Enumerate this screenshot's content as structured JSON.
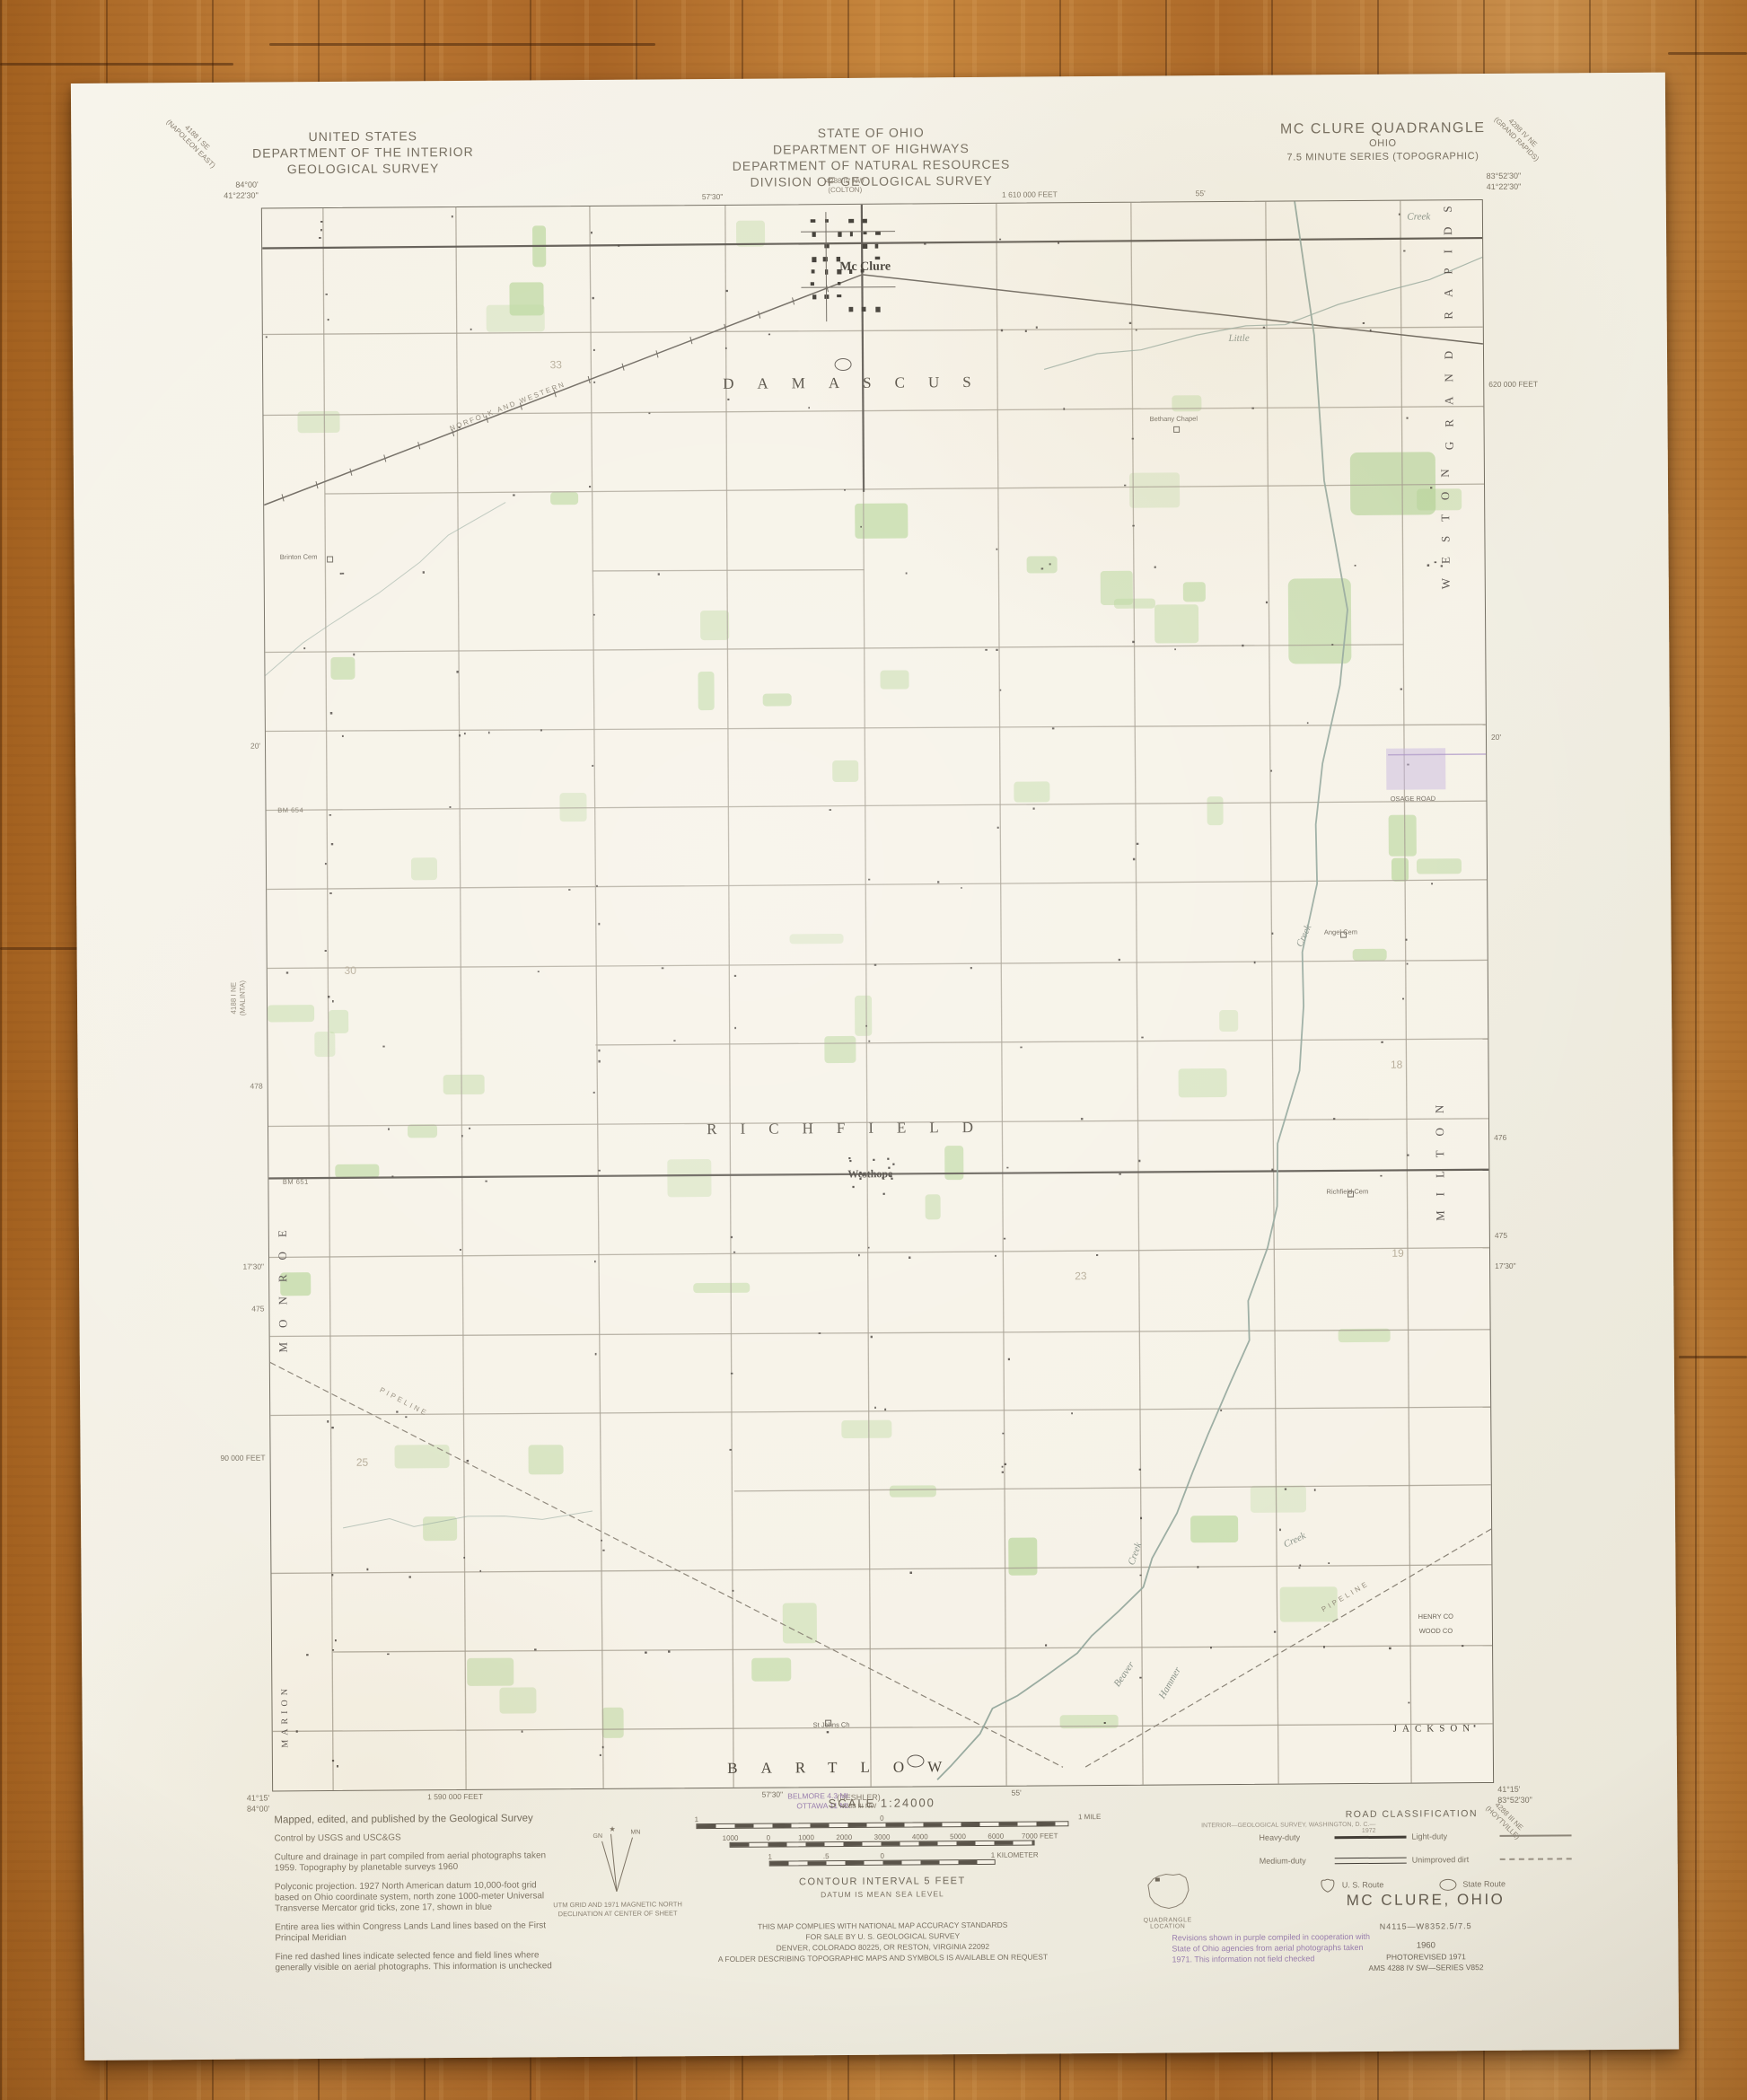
{
  "colors": {
    "paper": "#f6f2e7",
    "wood": "#b5722e",
    "ink": "#6a6257",
    "purple": "#9a7fae",
    "green": "#cfe3b3",
    "township_ink": "#4e483d"
  },
  "header": {
    "usgs": [
      "UNITED STATES",
      "DEPARTMENT OF THE INTERIOR",
      "GEOLOGICAL SURVEY"
    ],
    "ohio": [
      "STATE OF OHIO",
      "DEPARTMENT OF HIGHWAYS",
      "DEPARTMENT OF NATURAL RESOURCES",
      "DIVISION OF GEOLOGICAL SURVEY"
    ],
    "quad": [
      "MC CLURE QUADRANGLE",
      "OHIO",
      "7.5 MINUTE SERIES (TOPOGRAPHIC)"
    ]
  },
  "corners": {
    "tl": [
      "84°00'",
      "41°22'30\""
    ],
    "tr": [
      "83°52'30\"",
      "41°22'30\""
    ],
    "bl": [
      "41°15'",
      "84°00'"
    ],
    "br": [
      "41°15'",
      "83°52'30\""
    ]
  },
  "adjoining": {
    "tl": [
      "4188 I SE",
      "(NAPOLEON EAST)"
    ],
    "tc": [
      "4288 IV NW",
      "(COLTON)"
    ],
    "tr": [
      "4288 IV NE",
      "(GRAND RAPIDS)"
    ],
    "left": [
      "4188 I NE",
      "(MALINTA)"
    ],
    "bc": [
      "(DESHLER)",
      "4288 III NW"
    ],
    "br": [
      "4288 III NE",
      "(HOYTVILLE)"
    ]
  },
  "map_labels": [
    {
      "t": "DAMASCUS",
      "x": 48.8,
      "y": 11.3,
      "c": "twp"
    },
    {
      "t": "RICHFIELD",
      "x": 47.8,
      "y": 58.4,
      "c": "twp"
    },
    {
      "t": "BARTLOW",
      "x": 47.0,
      "y": 98.8,
      "c": "twp"
    },
    {
      "t": "JACKSON",
      "x": 95.2,
      "y": 96.6,
      "c": "twp-sm"
    },
    {
      "t": "MARION",
      "x": 1.0,
      "y": 95.3,
      "c": "vtwp-sm",
      "r": -90
    },
    {
      "t": "MONROE",
      "x": 1.1,
      "y": 68.0,
      "c": "vtwp",
      "r": -90
    },
    {
      "t": "GRAND RAPIDS",
      "x": 97.2,
      "y": 7.6,
      "c": "vtwp",
      "r": -90
    },
    {
      "t": "WESTON",
      "x": 96.8,
      "y": 20.3,
      "c": "vtwp",
      "r": -90
    },
    {
      "t": "MILTON",
      "x": 96.0,
      "y": 60.4,
      "c": "vtwp",
      "r": -90
    },
    {
      "t": "Mc Clure",
      "x": 49.4,
      "y": 4.0,
      "c": "town"
    },
    {
      "t": "Westhope",
      "x": 49.3,
      "y": 61.3,
      "c": "town-sm"
    },
    {
      "t": "Little",
      "x": 80.0,
      "y": 8.6,
      "c": "creek"
    },
    {
      "t": "Creek",
      "x": 94.8,
      "y": 1.0,
      "c": "creek"
    },
    {
      "t": "Creek",
      "x": 85.0,
      "y": 46.4,
      "c": "creek",
      "r": -65
    },
    {
      "t": "Beaver",
      "x": 69.8,
      "y": 93.0,
      "c": "creek",
      "r": -55
    },
    {
      "t": "Creek",
      "x": 70.8,
      "y": 85.4,
      "c": "creek",
      "r": -70
    },
    {
      "t": "Hammer",
      "x": 73.6,
      "y": 93.6,
      "c": "creek",
      "r": -60
    },
    {
      "t": "Creek",
      "x": 83.9,
      "y": 84.6,
      "c": "creek",
      "r": -25
    },
    {
      "t": "NORFOLK AND WESTERN",
      "x": 20.0,
      "y": 12.6,
      "c": "rr",
      "r": -21
    },
    {
      "t": "PIPELINE",
      "x": 11.0,
      "y": 75.5,
      "c": "pipeline",
      "r": 28
    },
    {
      "t": "PIPELINE",
      "x": 88.0,
      "y": 88.2,
      "c": "pipeline",
      "r": -30
    },
    {
      "t": "St Johns Ch",
      "x": 45.8,
      "y": 96.1,
      "c": "tiny"
    },
    {
      "t": "Brinton Cem",
      "x": 2.8,
      "y": 22.0,
      "c": "tiny"
    },
    {
      "t": "Richfield Cem",
      "x": 88.4,
      "y": 62.6,
      "c": "tiny"
    },
    {
      "t": "Angel Cem",
      "x": 88.0,
      "y": 46.2,
      "c": "tiny"
    },
    {
      "t": "Bethany Chapel",
      "x": 74.6,
      "y": 13.7,
      "c": "tiny"
    },
    {
      "t": "OSAGE ROAD",
      "x": 94.0,
      "y": 37.8,
      "c": "tiny"
    },
    {
      "t": "HENRY CO",
      "x": 95.4,
      "y": 89.5,
      "c": "tiny"
    },
    {
      "t": "WOOD CO",
      "x": 95.4,
      "y": 90.4,
      "c": "tiny"
    },
    {
      "t": "BM 651",
      "x": 2.2,
      "y": 61.5,
      "c": "bm"
    },
    {
      "t": "BM 654",
      "x": 2.0,
      "y": 38.0,
      "c": "bm"
    },
    {
      "t": "25",
      "x": 7.5,
      "y": 79.3,
      "c": "num"
    },
    {
      "t": "30",
      "x": 6.8,
      "y": 48.2,
      "c": "num"
    },
    {
      "t": "23",
      "x": 66.5,
      "y": 67.8,
      "c": "num"
    },
    {
      "t": "19",
      "x": 92.5,
      "y": 66.5,
      "c": "num"
    },
    {
      "t": "18",
      "x": 92.5,
      "y": 54.6,
      "c": "num"
    },
    {
      "t": "33",
      "x": 24.0,
      "y": 10.0,
      "c": "num"
    }
  ],
  "edge_ticks": [
    {
      "s": "top",
      "p": 37,
      "t": "57'30\""
    },
    {
      "s": "top",
      "p": 63,
      "t": "1 610 000 FEET"
    },
    {
      "s": "top",
      "p": 77,
      "t": "55'"
    },
    {
      "s": "bottom",
      "p": 15,
      "t": "1 590 000 FEET"
    },
    {
      "s": "bottom",
      "p": 41,
      "t": "57'30\""
    },
    {
      "s": "bottom",
      "p": 61,
      "t": "55'"
    },
    {
      "s": "left",
      "p": 34,
      "t": "20'"
    },
    {
      "s": "left",
      "p": 55.5,
      "t": "478"
    },
    {
      "s": "left",
      "p": 66.9,
      "t": "17'30\""
    },
    {
      "s": "left",
      "p": 69.6,
      "t": "475"
    },
    {
      "s": "left",
      "p": 79,
      "t": "90 000 FEET"
    },
    {
      "s": "right",
      "p": 11.7,
      "t": "620 000 FEET"
    },
    {
      "s": "right",
      "p": 34,
      "t": "20'"
    },
    {
      "s": "right",
      "p": 59.3,
      "t": "476"
    },
    {
      "s": "right",
      "p": 65.5,
      "t": "475"
    },
    {
      "s": "right",
      "p": 67.4,
      "t": "17'30\""
    }
  ],
  "footer": {
    "notes": [
      "Mapped, edited, and published by the Geological Survey",
      "Control by USGS and USC&GS",
      "Culture and drainage in part compiled from aerial photographs taken 1959.  Topography by planetable surveys 1960",
      "Polyconic projection.  1927 North American datum 10,000-foot grid based on Ohio coordinate system, north zone 1000-meter Universal Transverse Mercator grid ticks, zone 17, shown in blue",
      "Entire area lies within Congress Lands Land lines based on the First Principal Meridian",
      "Fine red dashed lines indicate selected fence and field lines where generally visible on aerial photographs.  This information is unchecked"
    ],
    "decl_caption": [
      "UTM GRID AND 1971 MAGNETIC NORTH",
      "DECLINATION AT CENTER OF SHEET"
    ],
    "decl": {
      "gn": "GN",
      "mn": "MN"
    },
    "purple_destinations": [
      "BELMORE 4.3 MI.",
      "OTTAWA 11 MI."
    ],
    "scale": {
      "title": "SCALE 1:24000",
      "miles": {
        "labels": [
          "1",
          "0",
          "1 MILE"
        ],
        "pos": [
          0,
          50,
          106
        ]
      },
      "feet": {
        "labels": [
          "1000",
          "0",
          "1000",
          "2000",
          "3000",
          "4000",
          "5000",
          "6000",
          "7000 FEET"
        ],
        "pos": [
          0,
          12.5,
          25,
          37.5,
          50,
          62.5,
          75,
          87.5,
          102
        ]
      },
      "km": {
        "labels": [
          "1",
          ".5",
          "0",
          "1 KILOMETER"
        ],
        "pos": [
          0,
          25,
          50,
          109
        ]
      },
      "contour": "CONTOUR INTERVAL 5 FEET",
      "datum": "DATUM IS MEAN SEA LEVEL"
    },
    "compliance": [
      "THIS MAP COMPLIES WITH NATIONAL MAP ACCURACY STANDARDS",
      "FOR SALE BY U. S. GEOLOGICAL SURVEY",
      "DENVER, COLORADO 80225, OR RESTON, VIRGINIA 22092",
      "A FOLDER DESCRIBING TOPOGRAPHIC MAPS AND SYMBOLS IS AVAILABLE ON REQUEST"
    ],
    "credit": "INTERIOR—GEOLOGICAL SURVEY, WASHINGTON, D. C.—1972",
    "quad_location": "QUADRANGLE LOCATION",
    "purple_note": [
      "Revisions shown in purple compiled in cooperation with",
      "State of Ohio agencies from aerial photographs taken",
      "1971.  This information not field checked"
    ],
    "road_class": {
      "title": "ROAD CLASSIFICATION",
      "heavy": "Heavy-duty",
      "light": "Light-duty",
      "medium": "Medium-duty",
      "dirt": "Unimproved dirt",
      "us_route": "U. S. Route",
      "state_route": "State Route"
    },
    "titleblock": {
      "name": "MC CLURE, OHIO",
      "code": "N4115—W8352.5/7.5",
      "year": "1960",
      "photorev": "PHOTOREVISED 1971",
      "ams": "AMS 4288 IV SW—SERIES V852"
    }
  }
}
